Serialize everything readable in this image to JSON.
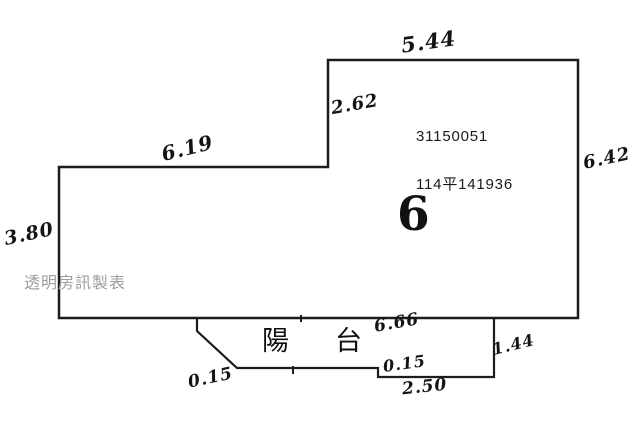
{
  "plan": {
    "unit_number": "6",
    "registration": {
      "line1": "31150051",
      "line2": "114平141936"
    },
    "balcony_label": "陽台",
    "watermark": "透明房訊製表",
    "measurements": {
      "top_edge": "5.44",
      "upper_left_edge": "2.62",
      "mid_horizontal_edge": "6.19",
      "right_edge": "6.42",
      "left_edge": "3.80",
      "balcony_top_width": "6.66",
      "balcony_right_edge": "1.44",
      "balcony_step": "0.15",
      "balcony_bottom_edge": "2.50",
      "balcony_left_cut": "0.15"
    },
    "line_color": "#1c1c1c",
    "background_color": "#ffffff"
  }
}
